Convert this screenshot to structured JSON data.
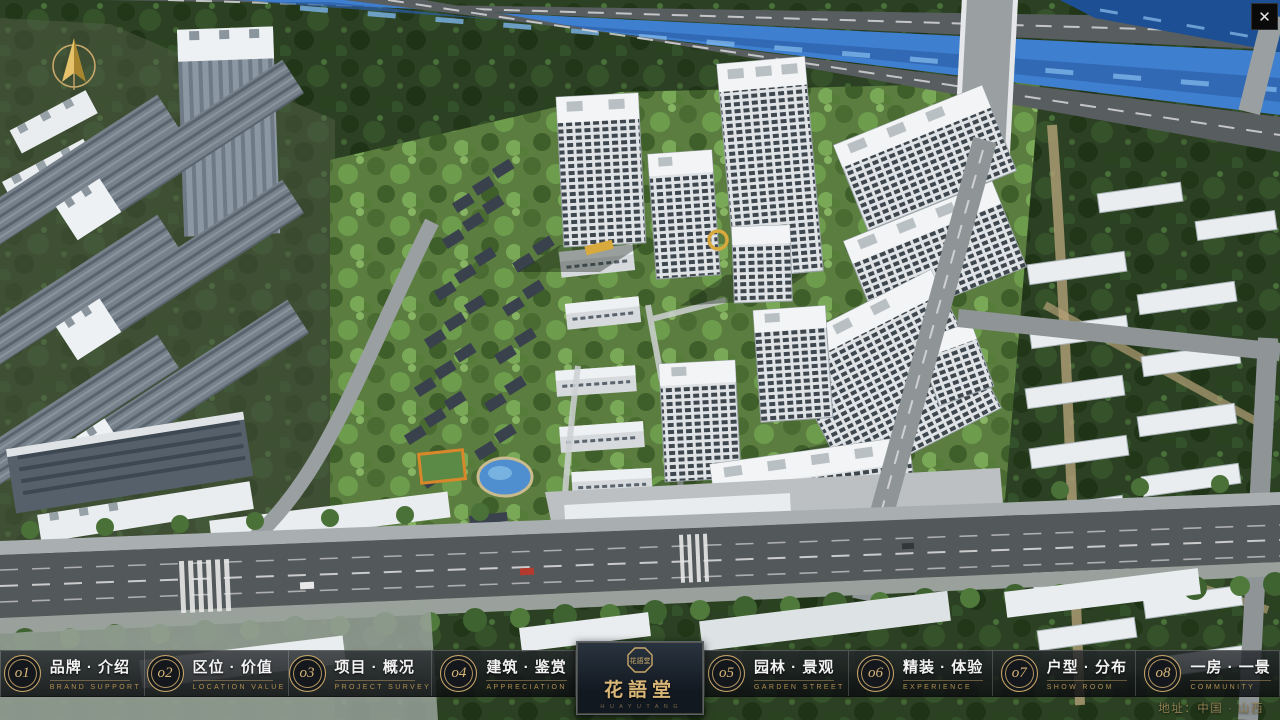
{
  "window": {
    "close_label": "✕"
  },
  "logo": {
    "title": "花語堂",
    "subtitle": "H U A Y U T A N G",
    "emblem_text": "花語堂"
  },
  "nav": {
    "items": [
      {
        "num": "o1",
        "zh": "品牌 · 介绍",
        "en": "BRAND SUPPORT"
      },
      {
        "num": "o2",
        "zh": "区位 · 价值",
        "en": "LOCATION VALUE"
      },
      {
        "num": "o3",
        "zh": "项目 · 概况",
        "en": "PROJECT SURVEY"
      },
      {
        "num": "o4",
        "zh": "建筑 · 鉴赏",
        "en": "APPRECIATION"
      },
      {
        "num": "o5",
        "zh": "园林 · 景观",
        "en": "GARDEN STREET"
      },
      {
        "num": "o6",
        "zh": "精装 · 体验",
        "en": "EXPERIENCE"
      },
      {
        "num": "o7",
        "zh": "户型 · 分布",
        "en": "SHOW ROOM"
      },
      {
        "num": "o8",
        "zh": "一房 · 一景",
        "en": "COMMUNITY"
      }
    ]
  },
  "footer": {
    "address": "地址：中国 · 山西"
  },
  "colors": {
    "gold": "#c9a86a",
    "panel_bg": "#1c2631",
    "river": "#3f7fd0"
  }
}
